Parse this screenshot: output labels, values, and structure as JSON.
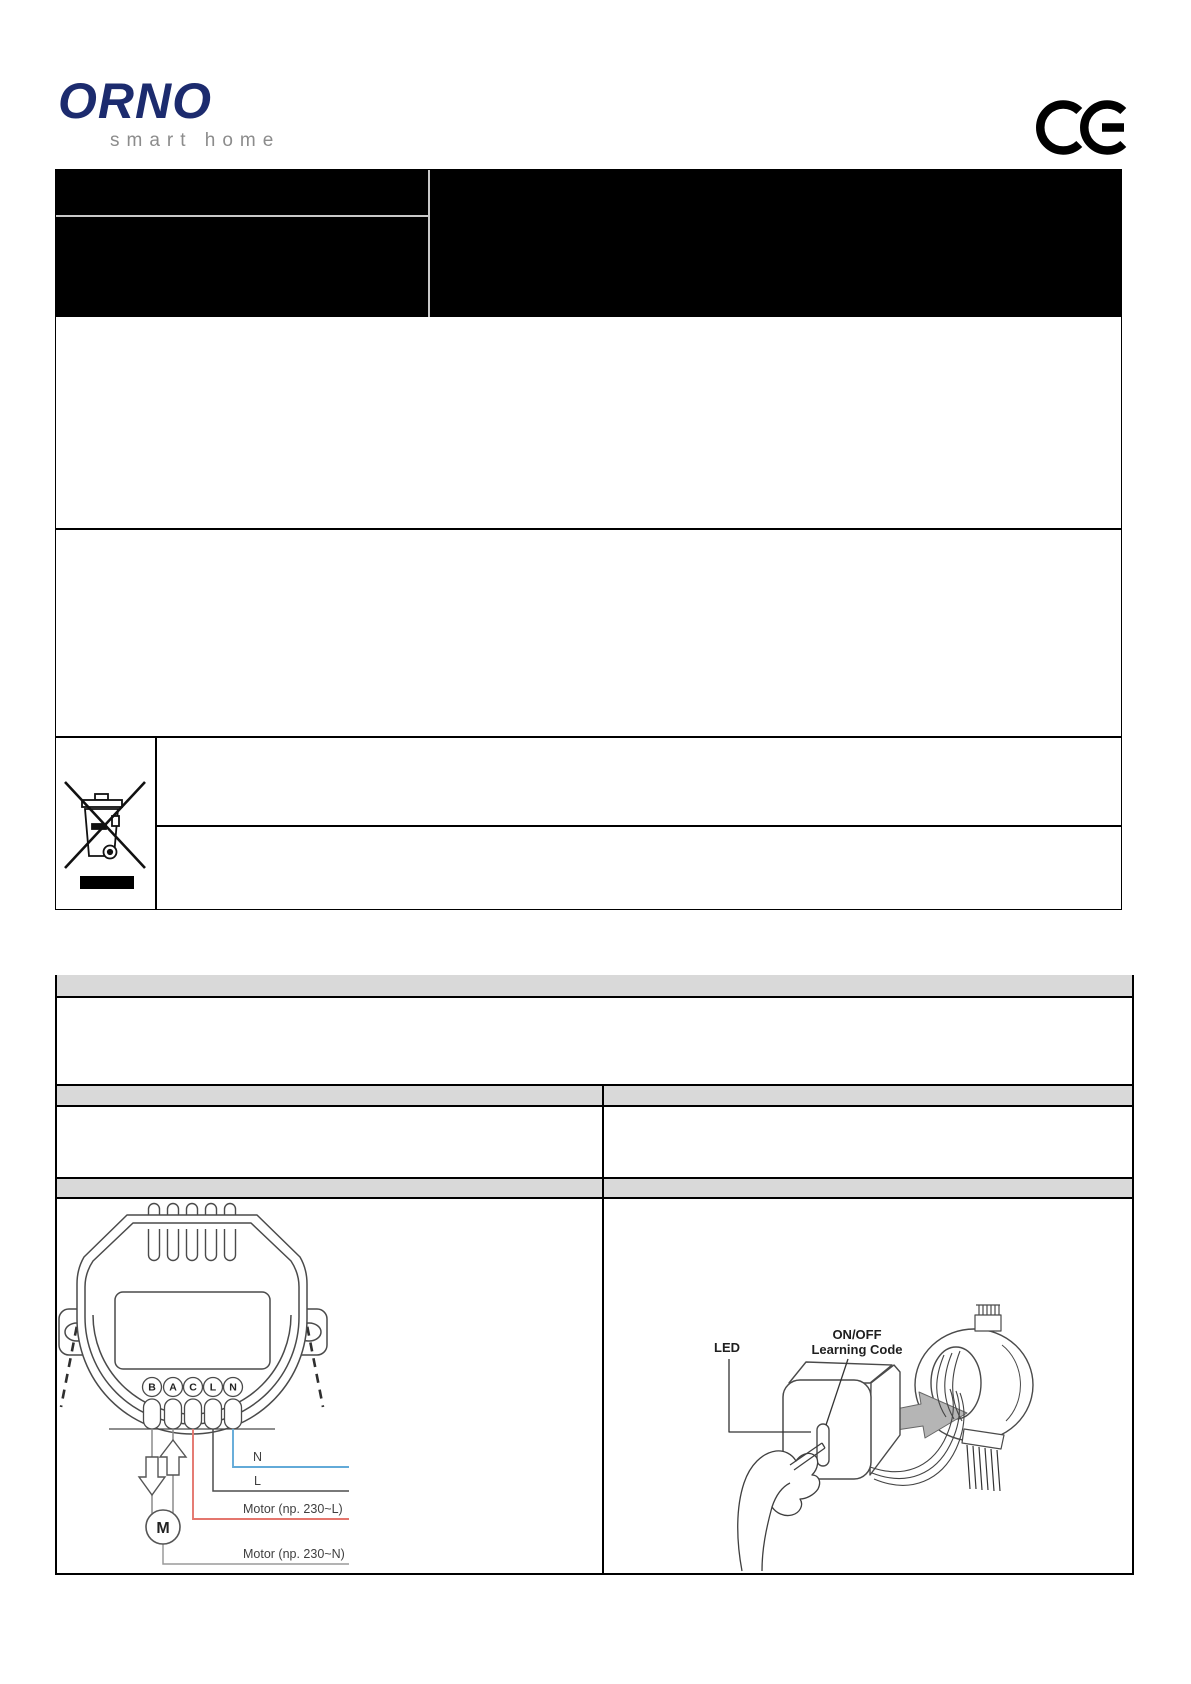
{
  "header": {
    "brand": "ORNO",
    "tagline": "smart home",
    "ce_mark_label": "CE"
  },
  "wiring": {
    "terminals": [
      "B",
      "A",
      "C",
      "L",
      "N"
    ],
    "motor_symbol": "M",
    "labels": {
      "n": "N",
      "l": "L",
      "motor_l": "Motor (np. 230~L)",
      "motor_n": "Motor (np. 230~N)"
    },
    "colors": {
      "wire_n": "#62aad8",
      "wire_l": "#4d4d4d",
      "wire_motor_l": "#e4766d",
      "wire_motor_n": "#9a9a9a"
    }
  },
  "pairing": {
    "led_label": "LED",
    "button_line1": "ON/OFF",
    "button_line2": "Learning Code"
  },
  "icons": {
    "ce": "ce-conformity-mark",
    "weee": "crossed-out-wheelie-bin"
  },
  "colors": {
    "brand_navy": "#1c2b6e",
    "tagline_gray": "#8c8c8c",
    "header_bar_black": "#000000",
    "table_header_gray": "#d9d9d9"
  }
}
